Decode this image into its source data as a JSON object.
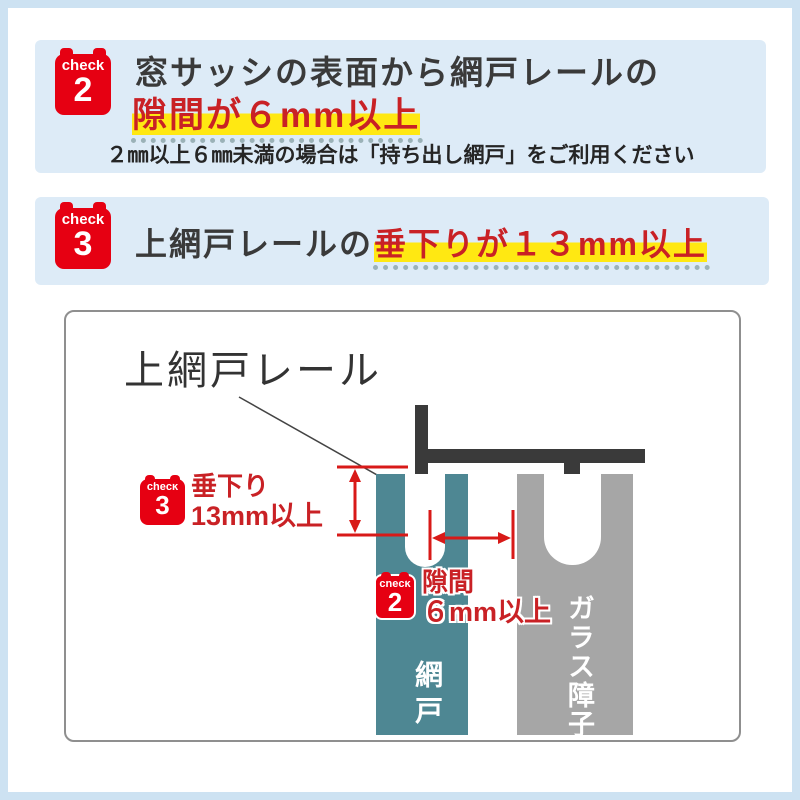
{
  "colors": {
    "frame_blue": "#cde2f2",
    "section_blue": "#ddebf7",
    "badge_red": "#e60012",
    "text_red": "#c92125",
    "highlight_yellow": "#ffe812",
    "underline_dots": "#9bb2b8",
    "screen_teal": "#4e8793",
    "glass_gray": "#a6a6a6",
    "rail_dark": "#3a3a3a"
  },
  "check2_section": {
    "badge": {
      "word": "check",
      "number": "2"
    },
    "heading_line1": "窓サッシの表面から網戸レールの",
    "heading_line2": "隙間が６mm以上",
    "note": "２㎜以上６㎜未満の場合は「持ち出し網戸」をご利用ください"
  },
  "check3_section": {
    "badge": {
      "word": "check",
      "number": "3"
    },
    "heading_plain": "上網戸レールの",
    "heading_highlight": "垂下りが１３mm以上"
  },
  "diagram": {
    "rail_pointer_label": "上網戸レール",
    "sag_callout": {
      "badge": {
        "word": "check",
        "number": "3"
      },
      "line1": "垂下り",
      "line2": "13mm以上"
    },
    "gap_callout": {
      "badge": {
        "word": "check",
        "number": "2"
      },
      "line1": "隙間",
      "line2": "６mm以上"
    },
    "screen_door_label": "網戸",
    "glass_shoji_label": "ガラス障子"
  }
}
